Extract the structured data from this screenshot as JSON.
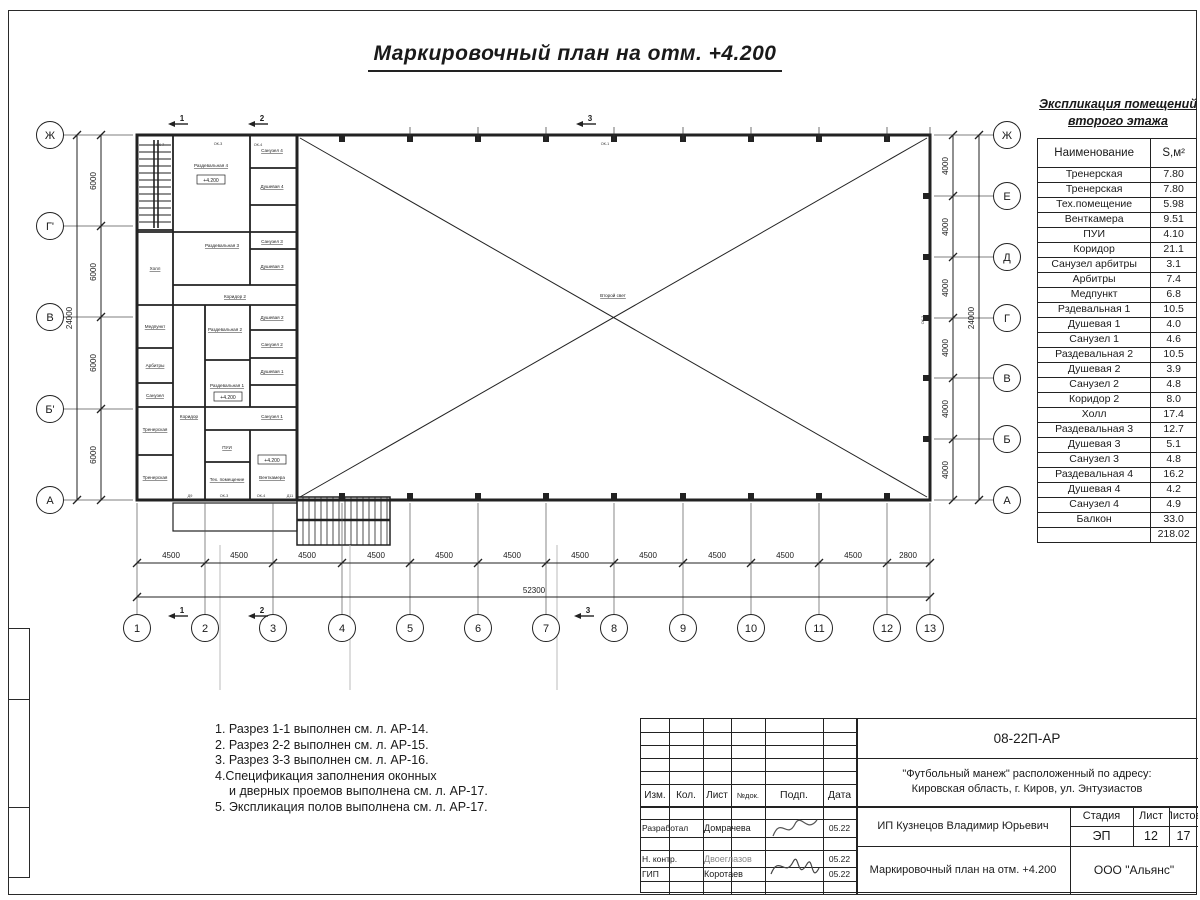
{
  "sheet_title": "Маркировочный план на отм. +4.200",
  "plan": {
    "axes_left": [
      "Ж",
      "Г'",
      "В",
      "Б'",
      "А"
    ],
    "axes_right": [
      "Ж",
      "Е",
      "Д",
      "Г",
      "В",
      "Б",
      "А"
    ],
    "axes_bottom": [
      "1",
      "2",
      "3",
      "4",
      "5",
      "6",
      "7",
      "8",
      "9",
      "10",
      "11",
      "12",
      "13"
    ],
    "dims_left": [
      "6000",
      "6000",
      "6000",
      "6000"
    ],
    "dims_left_total": "24000",
    "dims_right": [
      "4000",
      "4000",
      "4000",
      "4000",
      "4000",
      "4000"
    ],
    "dims_right_total": "24000",
    "dims_bottom": [
      "4500",
      "4500",
      "4500",
      "4500",
      "4500",
      "4500",
      "4500",
      "4500",
      "4500",
      "4500",
      "4500",
      "2800"
    ],
    "dims_bottom_total": "52300",
    "sections": [
      "1",
      "2",
      "3"
    ],
    "elevation": "+4.200",
    "second_light": "Второй свет",
    "rooms": {
      "raz4": "Раздевальная 4",
      "san4": "Санузел 4",
      "du4": "Душевая 4",
      "raz3": "Раздевальная 3",
      "san3": "Санузел 3",
      "du3": "Душевая 3",
      "kor2": "Коридор 2",
      "holl": "Холл",
      "med": "Медпункт",
      "arb": "Арбитры",
      "san": "Санузел",
      "tren": "Тренерская",
      "raz2": "Раздевальная 2",
      "du2": "Душевая 2",
      "san2": "Санузел 2",
      "du1": "Душевая 1",
      "raz1": "Раздевальная 1",
      "san1": "Санузел 1",
      "kor": "Коридор",
      "pui": "ПУИ",
      "teh": "Тех. помещение",
      "vent": "Венткамера"
    },
    "tags": {
      "ok7": "ОК-7",
      "ok3": "ОК-3",
      "ok4": "ОК-4",
      "ok1": "ОК-1",
      "ok2": "ОК-2",
      "d9": "Д9",
      "d11": "Д11"
    }
  },
  "explication": {
    "title1": "Экспликация помещений",
    "title2": "второго этажа",
    "col_name": "Наименование",
    "col_area": "S,м²",
    "rows": [
      {
        "n": "Тренерская",
        "a": "7.80"
      },
      {
        "n": "Тренерская",
        "a": "7.80"
      },
      {
        "n": "Тех.помещение",
        "a": "5.98"
      },
      {
        "n": "Венткамера",
        "a": "9.51"
      },
      {
        "n": "ПУИ",
        "a": "4.10"
      },
      {
        "n": "Коридор",
        "a": "21.1"
      },
      {
        "n": "Санузел арбитры",
        "a": "3.1"
      },
      {
        "n": "Арбитры",
        "a": "7.4"
      },
      {
        "n": "Медпункт",
        "a": "6.8"
      },
      {
        "n": "Рздевальная 1",
        "a": "10.5"
      },
      {
        "n": "Душевая 1",
        "a": "4.0"
      },
      {
        "n": "Санузел 1",
        "a": "4.6"
      },
      {
        "n": "Раздевальная 2",
        "a": "10.5"
      },
      {
        "n": "Душевая 2",
        "a": "3.9"
      },
      {
        "n": "Санузел 2",
        "a": "4.8"
      },
      {
        "n": "Коридор 2",
        "a": "8.0"
      },
      {
        "n": "Холл",
        "a": "17.4"
      },
      {
        "n": "Раздевальная 3",
        "a": "12.7"
      },
      {
        "n": "Душевая 3",
        "a": "5.1"
      },
      {
        "n": "Санузел 3",
        "a": "4.8"
      },
      {
        "n": "Раздевальная 4",
        "a": "16.2"
      },
      {
        "n": "Душевая 4",
        "a": "4.2"
      },
      {
        "n": "Санузел 4",
        "a": "4.9"
      },
      {
        "n": "Балкон",
        "a": "33.0"
      }
    ],
    "total": "218.02"
  },
  "notes": [
    "1. Разрез 1-1 выполнен см. л. АР-14.",
    "2. Разрез 2-2 выполнен см. л. АР-15.",
    "3. Разрез 3-3 выполнен см. л. АР-16.",
    "4.Спецификация заполнения оконных",
    "и дверных проемов выполнена см. л. АР-17.",
    "5. Экспликация полов выполнена см. л. АР-17."
  ],
  "stamp": {
    "doc": "08-22П-АР",
    "object1": "\"Футбольный манеж\" расположенный по адресу:",
    "object2": "Кировская область, г. Киров, ул. Энтузиастов",
    "cols": {
      "izm": "Изм.",
      "kol": "Кол.",
      "list": "Лист",
      "doc": "№док.",
      "sign": "Подп.",
      "date": "Дата"
    },
    "rows": [
      {
        "role": "Разработал",
        "name": "Домрачева",
        "date": "05.22"
      },
      {
        "role": "Н. контр.",
        "name": "Двоеглазов",
        "date": "05.22"
      },
      {
        "role": "ГИП",
        "name": "Коротаев",
        "date": "05.22"
      }
    ],
    "client": "ИП Кузнецов Владимир Юрьевич",
    "stage_label": "Стадия",
    "list_label": "Лист",
    "listov_label": "Листов",
    "stage": "ЭП",
    "list": "12",
    "listov": "17",
    "drawing": "Маркировочный план на отм. +4.200",
    "company": "ООО \"Альянс\""
  }
}
